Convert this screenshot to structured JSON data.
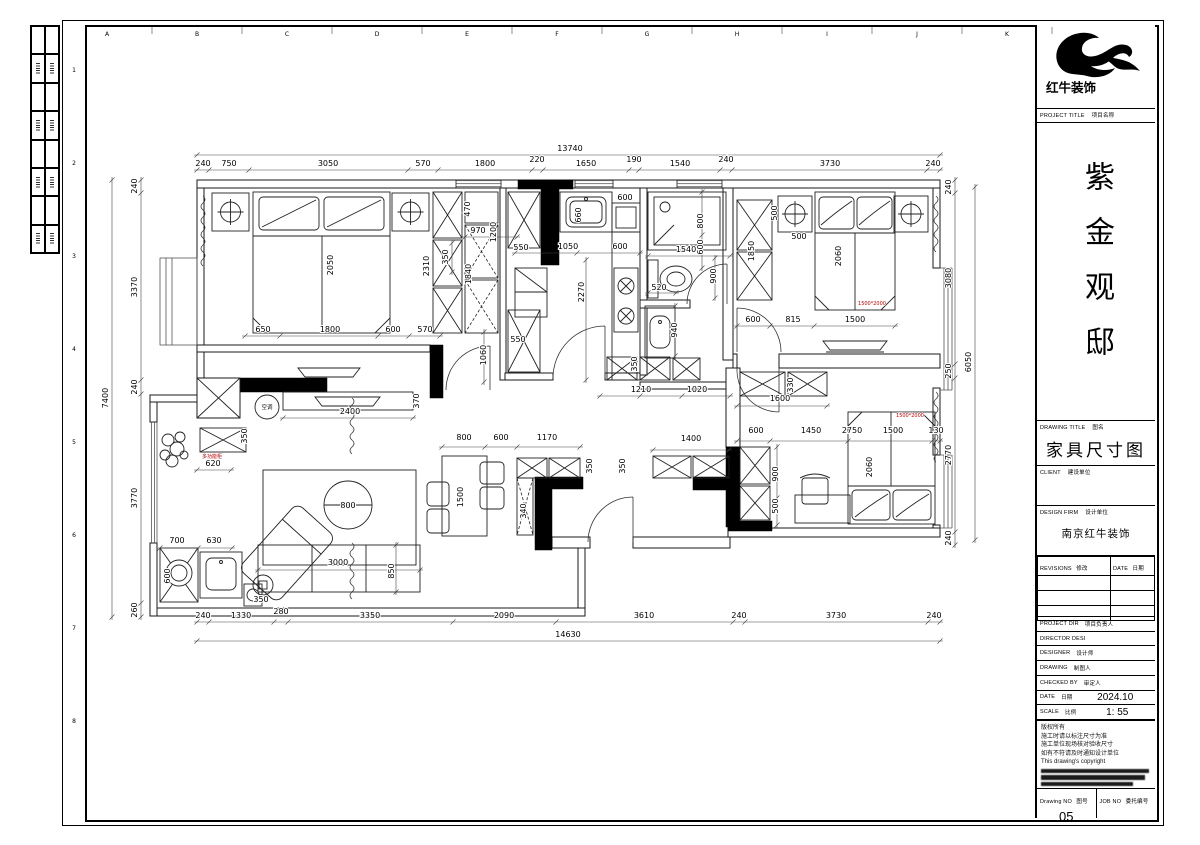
{
  "sheet": {
    "logo": {
      "text": "红牛装饰"
    },
    "project_title_label": {
      "en": "PROJECT TITLE",
      "cn": "项目名称"
    },
    "project_name": "紫金观邸",
    "drawing_title_label": {
      "en": "DRAWING TITLE",
      "cn": "图名"
    },
    "drawing_title": "家具尺寸图",
    "client_label": {
      "en": "CLIENT",
      "cn": "建设单位"
    },
    "design_firm_label": {
      "en": "DESIGN FIRM",
      "cn": "设计单位"
    },
    "design_firm": "南京红牛装饰",
    "revisions": {
      "col1_en": "REVISIONS",
      "col1_cn": "修改",
      "col2_en": "DATE",
      "col2_cn": "日期"
    },
    "info_rows": [
      {
        "en": "PROJECT DIR",
        "cn": "项目负责人",
        "value": ""
      },
      {
        "en": "DIRECTOR DESI",
        "cn": "",
        "value": ""
      },
      {
        "en": "DESIGNER",
        "cn": "设计师",
        "value": ""
      },
      {
        "en": "DRAWING",
        "cn": "制图人",
        "value": ""
      },
      {
        "en": "CHECKED BY",
        "cn": "审定人",
        "value": ""
      },
      {
        "en": "DATE",
        "cn": "日期",
        "value": "2024.10"
      },
      {
        "en": "SCALE",
        "cn": "比例",
        "value": "1: 55"
      }
    ],
    "notes": [
      "版权所有",
      "施工时请以标注尺寸为准",
      "施工单位现场核对验收尺寸",
      "如有不符请及时通知设计单位",
      "This drawing's copyright"
    ],
    "drawing_no_label": {
      "en": "Drawing NO",
      "cn": "图号"
    },
    "drawing_no": "05",
    "job_no_label": {
      "en": "JOB NO",
      "cn": "委托编号"
    }
  },
  "grid": {
    "letters": [
      "A",
      "B",
      "C",
      "D",
      "E",
      "F",
      "G",
      "H",
      "I",
      "J",
      "K"
    ],
    "numbers": [
      "1",
      "2",
      "3",
      "4",
      "5",
      "6",
      "7",
      "8"
    ]
  },
  "plan": {
    "dim_labels": [
      [
        "13740",
        570,
        151,
        0
      ],
      [
        "240",
        203,
        166,
        0
      ],
      [
        "750",
        229,
        166,
        0
      ],
      [
        "3050",
        328,
        166,
        0
      ],
      [
        "570",
        423,
        166,
        0
      ],
      [
        "1800",
        485,
        166,
        0
      ],
      [
        "220",
        537,
        162,
        0
      ],
      [
        "1650",
        586,
        166,
        0
      ],
      [
        "190",
        634,
        162,
        0
      ],
      [
        "1540",
        680,
        166,
        0
      ],
      [
        "240",
        726,
        162,
        0
      ],
      [
        "3730",
        830,
        166,
        0
      ],
      [
        "240",
        933,
        166,
        0
      ],
      [
        "14630",
        568,
        637,
        0
      ],
      [
        "240",
        203,
        618,
        0
      ],
      [
        "1330",
        241,
        618,
        0
      ],
      [
        "280",
        281,
        614,
        0
      ],
      [
        "3350",
        370,
        618,
        0
      ],
      [
        "2090",
        504,
        618,
        0
      ],
      [
        "3610",
        644,
        618,
        0
      ],
      [
        "240",
        739,
        618,
        0
      ],
      [
        "3730",
        836,
        618,
        0
      ],
      [
        "240",
        934,
        618,
        0
      ],
      [
        "7400",
        108,
        398,
        1
      ],
      [
        "240",
        137,
        186,
        1
      ],
      [
        "3370",
        137,
        287,
        1
      ],
      [
        "240",
        137,
        387,
        1
      ],
      [
        "3770",
        137,
        498,
        1
      ],
      [
        "260",
        137,
        610,
        1
      ],
      [
        "6050",
        971,
        362,
        1
      ],
      [
        "240",
        951,
        187,
        1
      ],
      [
        "3080",
        951,
        278,
        1
      ],
      [
        "250",
        951,
        371,
        1
      ],
      [
        "2770",
        951,
        455,
        1
      ],
      [
        "240",
        951,
        538,
        1
      ],
      [
        "2050",
        333,
        265,
        1
      ],
      [
        "2310",
        429,
        266,
        1
      ],
      [
        "350",
        448,
        257,
        1
      ],
      [
        "470",
        470,
        209,
        1
      ],
      [
        "970",
        478,
        233,
        0
      ],
      [
        "1200",
        496,
        232,
        1
      ],
      [
        "1840",
        471,
        274,
        1
      ],
      [
        "550",
        521,
        250,
        0
      ],
      [
        "550",
        518,
        342,
        0
      ],
      [
        "650",
        263,
        332,
        0
      ],
      [
        "1800",
        330,
        332,
        0
      ],
      [
        "600",
        393,
        332,
        0
      ],
      [
        "570",
        425,
        332,
        0
      ],
      [
        "1060",
        486,
        355,
        1
      ],
      [
        "660",
        581,
        215,
        1
      ],
      [
        "1050",
        568,
        249,
        0
      ],
      [
        "600",
        620,
        249,
        0
      ],
      [
        "600",
        625,
        200,
        0
      ],
      [
        "2270",
        584,
        292,
        1
      ],
      [
        "350",
        637,
        364,
        1
      ],
      [
        "800",
        703,
        221,
        1
      ],
      [
        "600",
        703,
        247,
        1
      ],
      [
        "1540",
        686,
        252,
        0
      ],
      [
        "520",
        659,
        290,
        0
      ],
      [
        "900",
        716,
        276,
        1
      ],
      [
        "940",
        677,
        330,
        1
      ],
      [
        "1210",
        641,
        392,
        0
      ],
      [
        "1020",
        697,
        392,
        0
      ],
      [
        "500",
        777,
        213,
        1
      ],
      [
        "1850",
        754,
        251,
        1
      ],
      [
        "500",
        799,
        239,
        0
      ],
      [
        "2060",
        841,
        256,
        1
      ],
      [
        "600",
        753,
        322,
        0
      ],
      [
        "815",
        793,
        322,
        0
      ],
      [
        "1500",
        855,
        322,
        0
      ],
      [
        "330",
        793,
        385,
        1
      ],
      [
        "1600",
        780,
        401,
        0
      ],
      [
        "600",
        756,
        433,
        0
      ],
      [
        "1450",
        811,
        433,
        0
      ],
      [
        "2750",
        852,
        433,
        0
      ],
      [
        "1500",
        893,
        433,
        0
      ],
      [
        "130",
        936,
        433,
        0
      ],
      [
        "900",
        778,
        474,
        1
      ],
      [
        "500",
        778,
        506,
        1
      ],
      [
        "2060",
        872,
        467,
        1
      ],
      [
        "2400",
        350,
        414,
        0
      ],
      [
        "370",
        419,
        401,
        1
      ],
      [
        "620",
        213,
        466,
        0
      ],
      [
        "350",
        247,
        436,
        1
      ],
      [
        "700",
        177,
        543,
        0
      ],
      [
        "630",
        214,
        543,
        0
      ],
      [
        "600",
        170,
        576,
        1
      ],
      [
        "350",
        261,
        602,
        0
      ],
      [
        "3000",
        338,
        565,
        0
      ],
      [
        "850",
        394,
        571,
        1
      ],
      [
        "800",
        348,
        508,
        0
      ],
      [
        "800",
        464,
        440,
        0
      ],
      [
        "600",
        501,
        440,
        0
      ],
      [
        "1170",
        547,
        440,
        0
      ],
      [
        "1500",
        463,
        497,
        1
      ],
      [
        "340",
        526,
        511,
        1
      ],
      [
        "350",
        592,
        466,
        1
      ],
      [
        "350",
        625,
        466,
        1
      ],
      [
        "1400",
        691,
        441,
        0
      ]
    ],
    "red_labels": [
      [
        "1500*2000",
        872,
        305
      ],
      [
        "1500*2000",
        910,
        417
      ],
      [
        "多功能柜",
        212,
        458
      ]
    ],
    "equipment_labels": [
      [
        "空调",
        267,
        409
      ]
    ]
  }
}
